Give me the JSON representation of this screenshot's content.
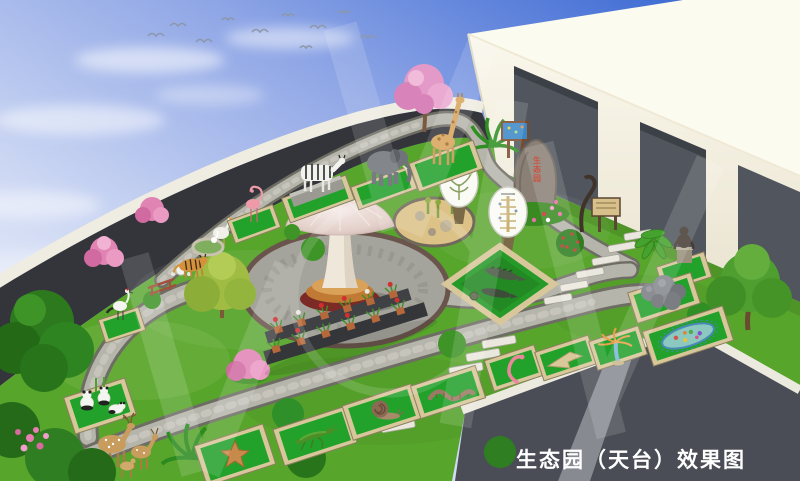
{
  "title": "生态园（天台）效果图",
  "caption": {
    "text": "生态园（天台）效果图"
  },
  "rock_inscription": {
    "text": "生态园"
  },
  "colors": {
    "sky_top": "#3f6cd4",
    "sky_mid": "#8fa6e6",
    "sky_horizon": "#f2f4fb",
    "building_wall": "#f6f2e4",
    "building_roof": "#fcfbef",
    "window_opening": "#51555d",
    "parapet_wall": "#33353a",
    "roof_rim": "#efece1",
    "lawn_green": "#58a52c",
    "path_gray": "#b6b5ac",
    "exhibit_mat_green": "#22a12b",
    "mat_frame_tan": "#d8c79b",
    "ground_dark": "#4b4d56",
    "caption_white": "#ffffff"
  },
  "exhibits": [
    "pelican-sculpture",
    "flamingo-sculpture",
    "zebra-sculpture",
    "elephant-sculpture",
    "giraffe-sculpture",
    "tiger-sculpture",
    "crane-sculpture",
    "swan-sculpture",
    "panda-sculptures",
    "deer-sculptures",
    "crocodile-enclosure",
    "monkey-sculpture",
    "starfish-sculpture",
    "grasshopper-sculpture",
    "snail-sculpture",
    "earthworm-sculpture",
    "leech-sculpture",
    "planarian-sculpture",
    "hydra-sculpture",
    "paramecium-model",
    "mushroom-pavilion",
    "rockery-bed",
    "inscribed-rock",
    "evolution-boards",
    "info-sign",
    "wooden-sign",
    "rock-cluster",
    "potted-plant-stand"
  ]
}
